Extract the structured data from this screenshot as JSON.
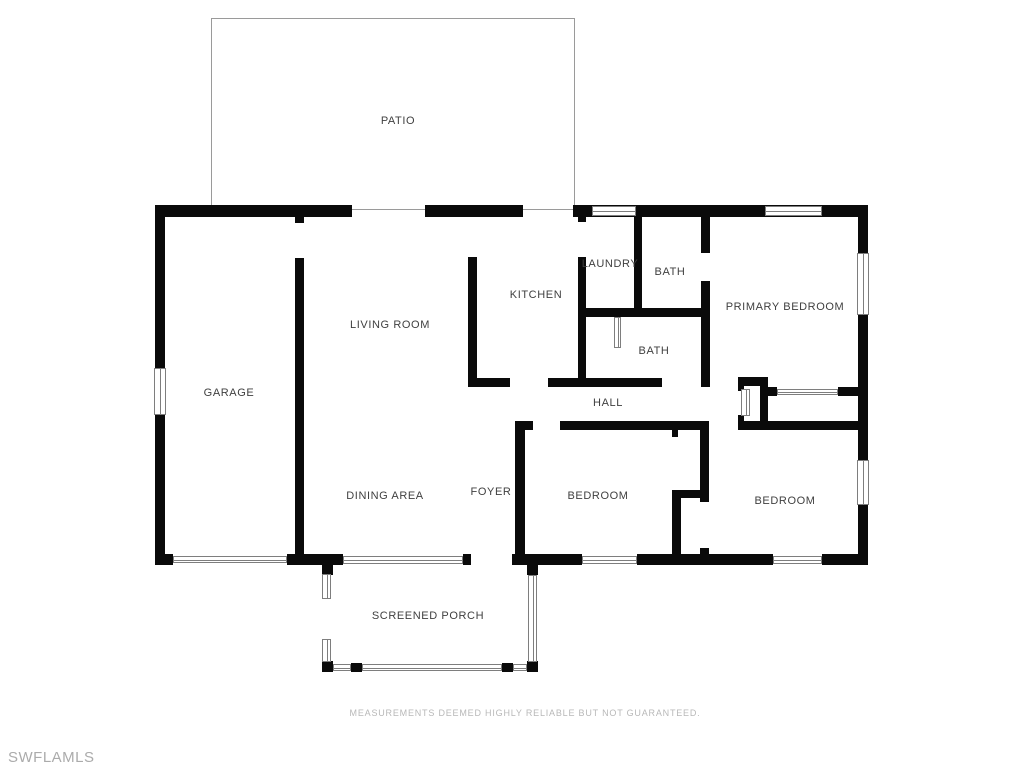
{
  "title": "Residential floor plan",
  "rooms": {
    "patio": {
      "label": "PATIO"
    },
    "laundry": {
      "label": "LAUNDRY"
    },
    "bath1": {
      "label": "BATH"
    },
    "kitchen": {
      "label": "KITCHEN"
    },
    "living": {
      "label": "LIVING ROOM"
    },
    "primary": {
      "label": "PRIMARY BEDROOM"
    },
    "bath2": {
      "label": "BATH"
    },
    "garage": {
      "label": "GARAGE"
    },
    "hall": {
      "label": "HALL"
    },
    "dining": {
      "label": "DINING AREA"
    },
    "foyer": {
      "label": "FOYER"
    },
    "bedroom1": {
      "label": "BEDROOM"
    },
    "bedroom2": {
      "label": "BEDROOM"
    },
    "porch": {
      "label": "SCREENED PORCH"
    }
  },
  "footer": {
    "disclaimer": "MEASUREMENTS DEEMED HIGHLY RELIABLE BUT NOT GUARANTEED."
  },
  "watermark": "SWFLAMLS",
  "colors": {
    "wall": "#0a0a0a",
    "thin_line": "#7e7e7e",
    "patio_line": "#9a9a9a",
    "label_text": "#3f3f3f",
    "disclaimer_text": "#b8b8b8",
    "watermark_text": "#ababab",
    "background": "#ffffff"
  }
}
